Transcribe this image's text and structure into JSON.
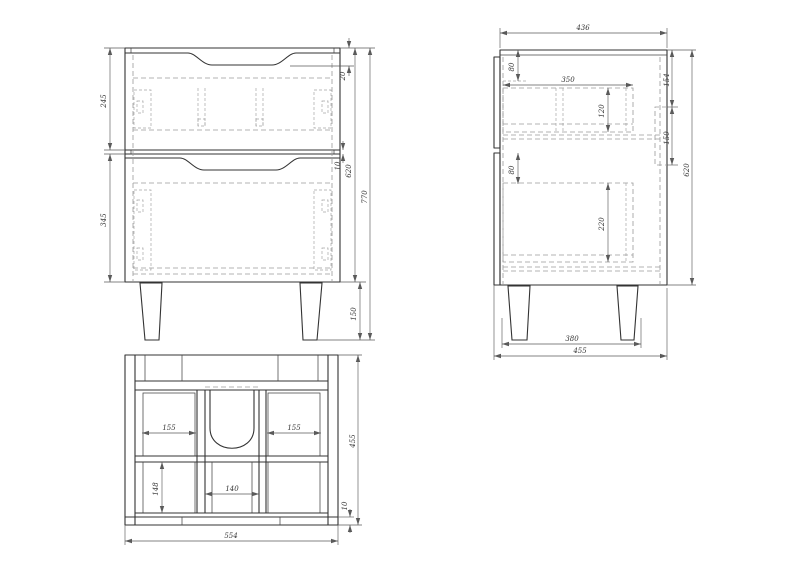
{
  "drawing": {
    "type": "furniture-technical-drawing",
    "subject": "vanity cabinet with two drawers, three orthographic views",
    "background": "#ffffff",
    "outline_color": "#333333",
    "hidden_line_color": "#9a9a9a",
    "dimension_color": "#5a5a5a"
  },
  "views": {
    "front": {
      "label": "front-view",
      "dims": {
        "drawer1_height": "245",
        "drawer2_height": "345",
        "top_inset": "20",
        "drawer_gap": "10",
        "body_height": "620",
        "overall_height": "770",
        "leg_height": "150"
      }
    },
    "side": {
      "label": "side-view",
      "dims": {
        "top_depth": "436",
        "hole_offset_top": "80",
        "drawer_depth": "350",
        "drawer1_inner_height": "120",
        "back_cutout_offset": "154",
        "back_cutout_height": "150",
        "body_height": "620",
        "hole_offset_bottom": "80",
        "drawer2_inner_height": "220",
        "leg_span": "380",
        "overall_depth": "455"
      }
    },
    "bottom": {
      "label": "bottom-view",
      "dims": {
        "left_section_width": "155",
        "right_section_width": "155",
        "center_section_width": "140",
        "left_section_depth": "148",
        "overall_depth": "455",
        "rail_thickness": "10",
        "overall_width": "554"
      }
    }
  }
}
